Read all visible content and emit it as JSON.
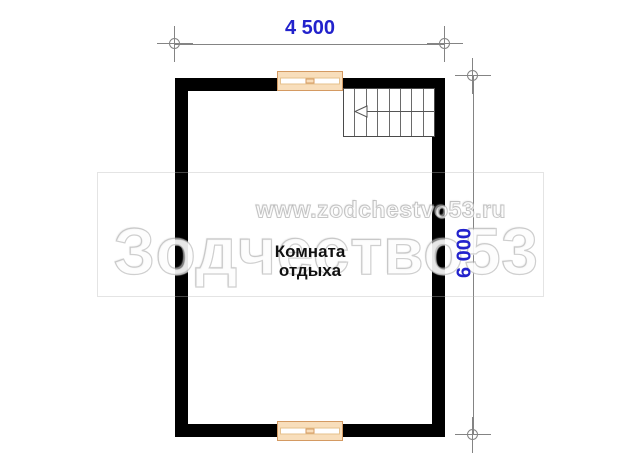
{
  "watermark": {
    "brand": "Зодчество53",
    "url": "www.zodchestvo53.ru"
  },
  "room": {
    "name_line1": "Комната",
    "name_line2": "отдыха"
  },
  "dimensions": {
    "width": "4 500",
    "height": "6 000"
  },
  "stairs": {
    "treads": 8,
    "arrow_direction": "left"
  },
  "colors": {
    "wall": "#000000",
    "dimension_text": "#2222cc",
    "dimension_line": "#848484",
    "window_fill": "#f8debb",
    "window_border": "#d49a62",
    "stair_line": "#6a6a6a",
    "watermark_outline": "#a8a8a8"
  }
}
